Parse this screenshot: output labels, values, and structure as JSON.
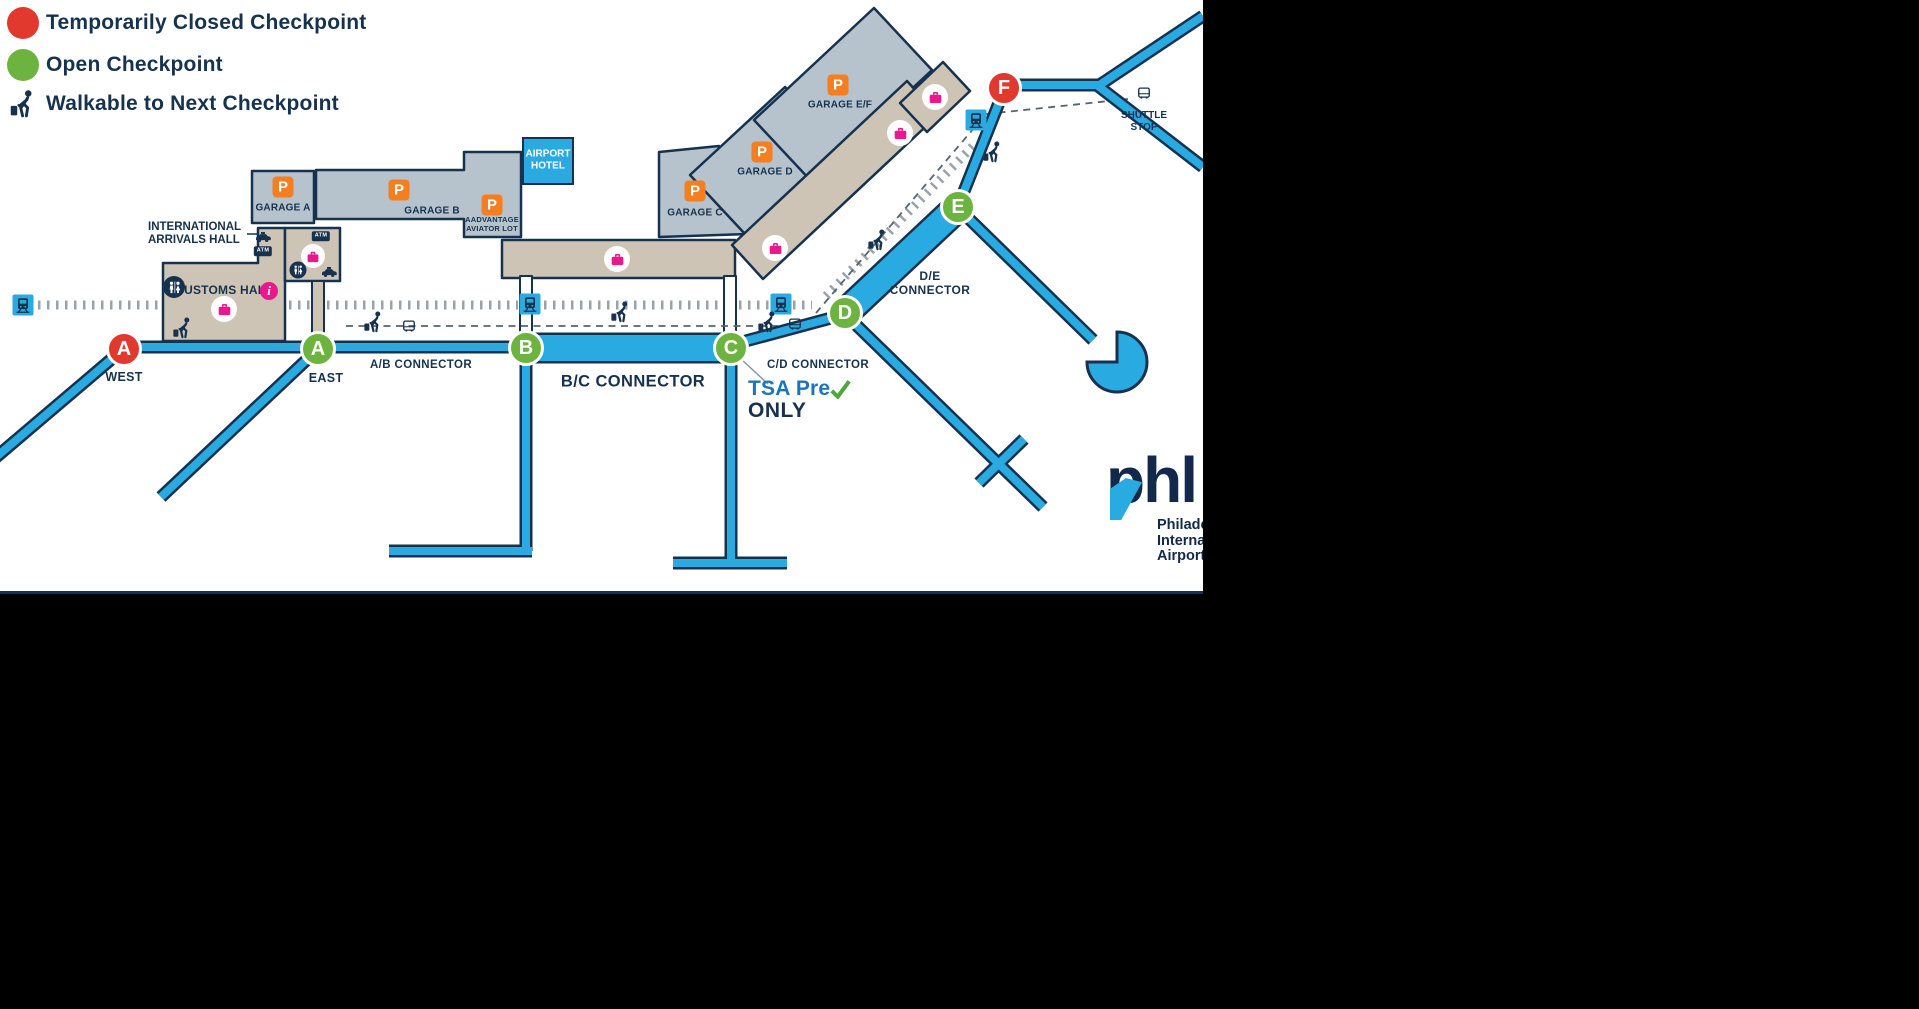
{
  "legend": {
    "items": [
      {
        "icon": "closed-checkpoint-dot",
        "label": "Temporarily Closed Checkpoint",
        "color": "#e2392f"
      },
      {
        "icon": "open-checkpoint-dot",
        "label": "Open Checkpoint",
        "color": "#6db33f"
      },
      {
        "icon": "walking-person-icon",
        "label": "Walkable to Next Checkpoint"
      }
    ]
  },
  "checkpoints": [
    {
      "letter": "A",
      "sublabel": "WEST",
      "status": "closed"
    },
    {
      "letter": "A",
      "sublabel": "EAST",
      "status": "open"
    },
    {
      "letter": "B",
      "status": "open"
    },
    {
      "letter": "C",
      "status": "open"
    },
    {
      "letter": "D",
      "status": "open"
    },
    {
      "letter": "E",
      "status": "open"
    },
    {
      "letter": "F",
      "status": "closed"
    }
  ],
  "connectors": {
    "ab": "A/B CONNECTOR",
    "bc": "B/C CONNECTOR",
    "cd": "C/D CONNECTOR",
    "de": "D/E CONNECTOR"
  },
  "buildings": {
    "intl_arrivals": "INTERNATIONAL ARRIVALS HALL",
    "customs": "CUSTOMS HALL",
    "garage_a": "GARAGE A",
    "garage_b": "GARAGE B",
    "garage_c": "GARAGE C",
    "garage_d": "GARAGE D",
    "garage_ef": "GARAGE E/F",
    "aviator": "AADVANTAGE AVIATOR LOT",
    "hotel": "AIRPORT HOTEL"
  },
  "tsa": {
    "pre": "TSA Pre",
    "only": "ONLY"
  },
  "shuttle_stop": "SHUTTLE STOP",
  "icons": {
    "parking": "P",
    "atm": "ATM",
    "info": "i"
  },
  "logo": {
    "mark": "phl",
    "name": "Philadelphia International Airport"
  },
  "colors": {
    "road_blue": "#29abe2",
    "navy": "#16324f",
    "closed_red": "#e2392f",
    "open_green": "#6db33f",
    "parking_orange": "#f57e20",
    "amenity_magenta": "#e9188c",
    "building_gray": "#b7c3cc",
    "building_tan": "#cec4b6",
    "tsa_blue": "#1b75bc",
    "check_green": "#50a63e"
  }
}
